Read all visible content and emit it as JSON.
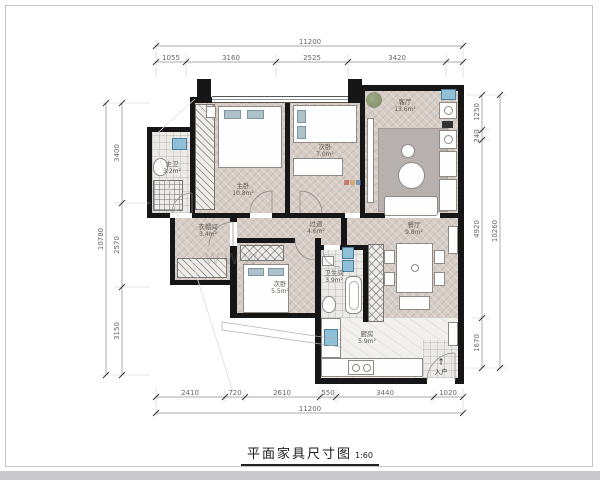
{
  "title": {
    "text": "平面家具尺寸图",
    "scale": "1:60"
  },
  "watermark": {
    "text": "WWW",
    "logo_colors": [
      "#b43c30",
      "#d98a2b",
      "#3b6ea5"
    ]
  },
  "entrance": {
    "label": "入户",
    "arrow": "↑"
  },
  "dims": {
    "top": {
      "overall": "11200",
      "segments": [
        "1055",
        "3160",
        "2525",
        "3420"
      ]
    },
    "bottom": {
      "overall": "11200",
      "segments": [
        "2410",
        "720",
        "2610",
        "550",
        "3440",
        "1020"
      ]
    },
    "left": {
      "overall": "10780",
      "segments": [
        "3400",
        "2570",
        "3150"
      ]
    },
    "right": {
      "overall": "10260",
      "segments": [
        "1250",
        "240",
        "4920",
        "1670"
      ]
    }
  },
  "rooms": {
    "master_bedroom": {
      "name": "主卧",
      "area": "10.8m²"
    },
    "master_bath": {
      "name": "主卫",
      "area": "3.2m²"
    },
    "study": {
      "name": "次卧",
      "area": "7.0m²"
    },
    "living": {
      "name": "客厅",
      "area": "13.6m²"
    },
    "dining": {
      "name": "餐厅",
      "area": "9.8m²"
    },
    "hallway": {
      "name": "过道",
      "area": "4.6m²"
    },
    "closet": {
      "name": "衣帽间",
      "area": "3.4m²"
    },
    "bedroom2": {
      "name": "次卧",
      "area": "5.5m²"
    },
    "bath2": {
      "name": "卫生间",
      "area": "3.9m²"
    },
    "kitchen": {
      "name": "厨房",
      "area": "5.9m²"
    }
  }
}
